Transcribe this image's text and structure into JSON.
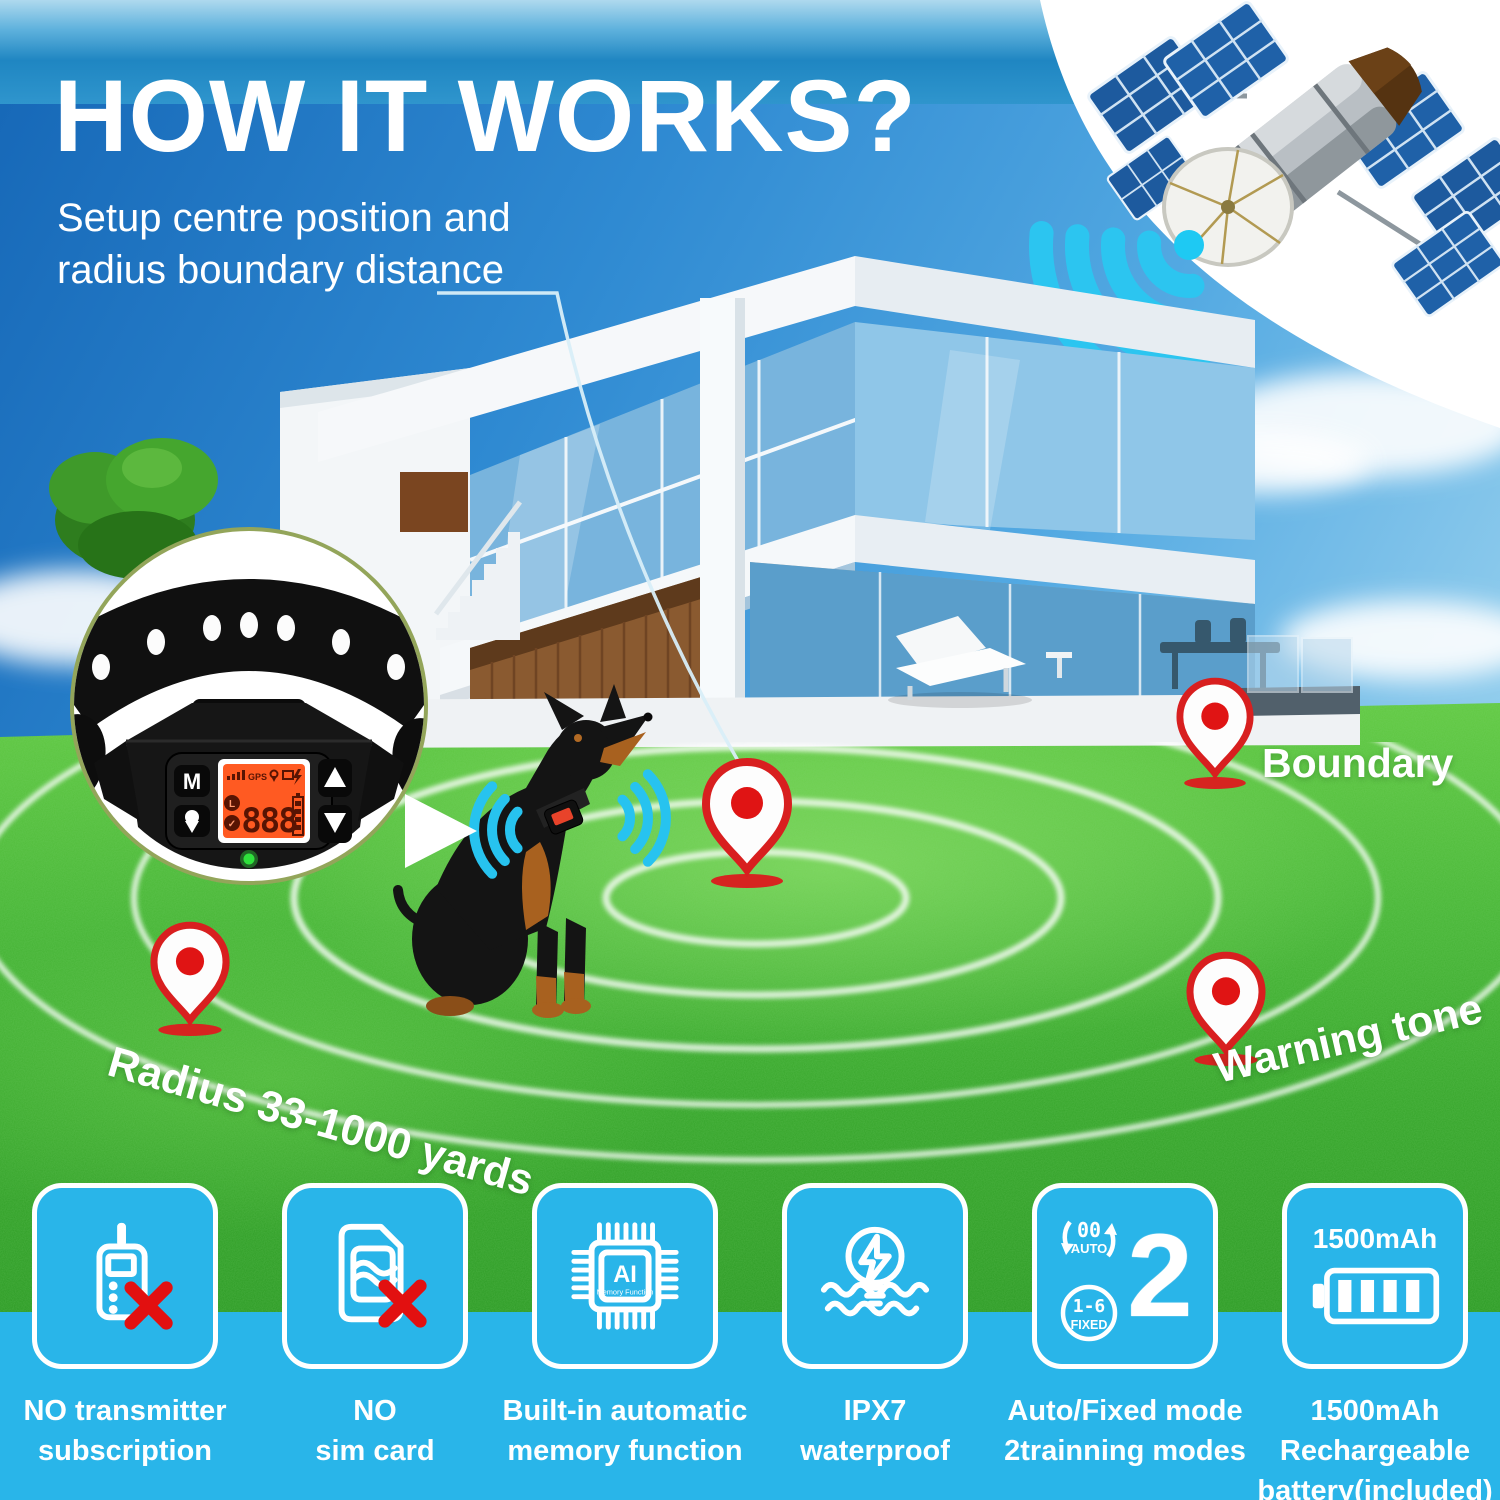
{
  "header": {
    "title": "HOW IT WORKS?",
    "subtitle_lines": [
      "Setup centre position and",
      "radius boundary distance"
    ]
  },
  "scene": {
    "boundary_label": "Boundary",
    "radius_label": "Radius 33-1000 yards",
    "warning_label": "Warning tone",
    "collar_inset": {
      "mode_button": "M",
      "lcd": {
        "gps": "GPS",
        "digits": "888"
      }
    }
  },
  "features": [
    {
      "id": "no-transmitter",
      "lines": [
        "NO transmitter",
        "subscription"
      ]
    },
    {
      "id": "no-sim-card",
      "lines": [
        "NO",
        "sim card"
      ]
    },
    {
      "id": "memory-function",
      "lines": [
        "Built-in automatic",
        "memory function"
      ],
      "chip_label": "AI",
      "chip_sublabel": "Memory Function"
    },
    {
      "id": "waterproof",
      "lines": [
        "IPX7",
        "waterproof"
      ]
    },
    {
      "id": "training-modes",
      "lines": [
        "Auto/Fixed mode",
        "2trainning modes"
      ],
      "number": "2",
      "auto_badge": {
        "top": "00",
        "bottom": "AUTO"
      },
      "fixed_badge": {
        "top": "1-6",
        "bottom": "FIXED"
      }
    },
    {
      "id": "battery",
      "lines": [
        "1500mAh",
        "Rechargeable",
        "battery(included)"
      ],
      "capacity": "1500mAh"
    }
  ],
  "colors": {
    "accent_cyan": "#29b5e9",
    "signal_cyan": "#2cc5f0",
    "pin_red": "#dd1d22",
    "grass_green": "#3fae31",
    "sky_blue": "#2f8ad2",
    "lcd_orange": "#ff5a22"
  }
}
